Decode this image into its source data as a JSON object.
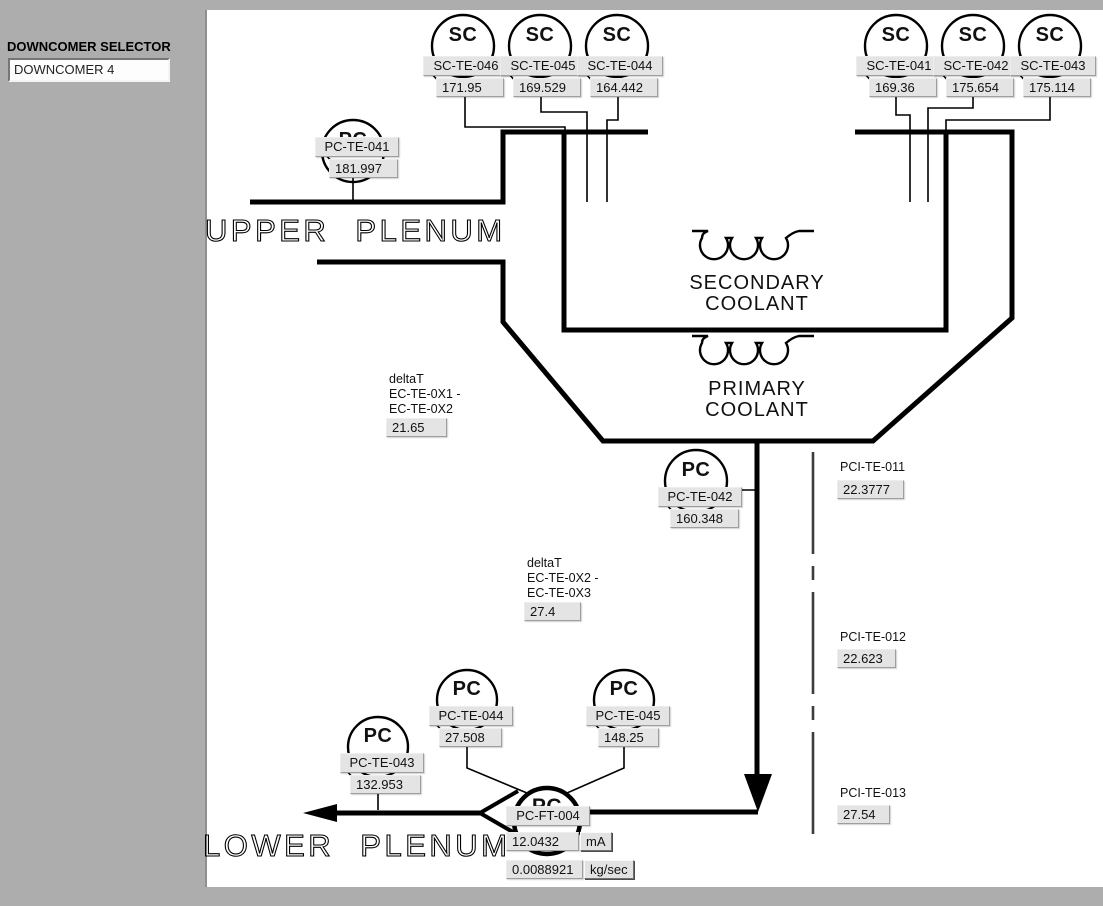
{
  "selector": {
    "label": "DOWNCOMER SELECTOR",
    "value": "DOWNCOMER 4"
  },
  "texts": {
    "upper_plenum": "UPPER PLENUM",
    "lower_plenum": "LOWER PLENUM",
    "secondary_1": "SECONDARY",
    "secondary_2": "COOLANT",
    "primary_1": "PRIMARY",
    "primary_2": "COOLANT"
  },
  "sc_left": [
    {
      "kind": "SC",
      "tag": "SC-TE-046",
      "value": "171.95"
    },
    {
      "kind": "SC",
      "tag": "SC-TE-045",
      "value": "169.529"
    },
    {
      "kind": "SC",
      "tag": "SC-TE-044",
      "value": "164.442"
    }
  ],
  "sc_right": [
    {
      "kind": "SC",
      "tag": "SC-TE-041",
      "value": "169.36"
    },
    {
      "kind": "SC",
      "tag": "SC-TE-042",
      "value": "175.654"
    },
    {
      "kind": "SC",
      "tag": "SC-TE-043",
      "value": "175.114"
    }
  ],
  "pc": {
    "te041": {
      "kind": "PC",
      "tag": "PC-TE-041",
      "value": "181.997"
    },
    "te042": {
      "kind": "PC",
      "tag": "PC-TE-042",
      "value": "160.348"
    },
    "te043": {
      "kind": "PC",
      "tag": "PC-TE-043",
      "value": "132.953"
    },
    "te044": {
      "kind": "PC",
      "tag": "PC-TE-044",
      "value": "27.508"
    },
    "te045": {
      "kind": "PC",
      "tag": "PC-TE-045",
      "value": "148.25"
    }
  },
  "flow_transmitter": {
    "kind": "PC",
    "tag": "PC-FT-004",
    "current": "12.0432",
    "current_unit": "mA",
    "flow": "0.0088921",
    "flow_unit": "kg/sec"
  },
  "delta_t": [
    {
      "title": "deltaT",
      "line1": "EC-TE-0X1 -",
      "line2": "EC-TE-0X2",
      "value": "21.65"
    },
    {
      "title": "deltaT",
      "line1": "EC-TE-0X2 -",
      "line2": "EC-TE-0X3",
      "value": "27.4"
    }
  ],
  "pci": [
    {
      "tag": "PCI-TE-011",
      "value": "22.3777"
    },
    {
      "tag": "PCI-TE-012",
      "value": "22.623"
    },
    {
      "tag": "PCI-TE-013",
      "value": "27.54"
    }
  ],
  "colors": {
    "line": "#000000",
    "panel": "#ffffff",
    "background": "#adadad",
    "box_fill": "#e4e4e4"
  }
}
